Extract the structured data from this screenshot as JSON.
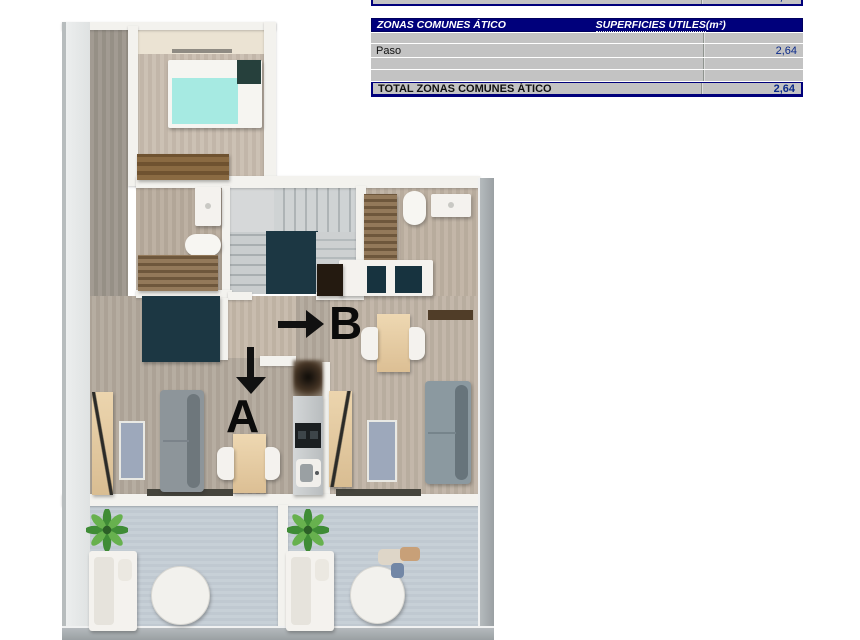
{
  "annotations": {
    "marker_a": "A",
    "marker_b": "B"
  },
  "table": {
    "row_estudio": {
      "label_u": "TOTAL",
      "label_rest": " ESTUDIO ÁTICO B",
      "value": "40,76"
    },
    "header": {
      "col1_u": "ZONAS",
      "col1_rest": " COMUNES ÁTICO",
      "col2_u": "SUPERFICIES UTILES",
      "col2_rest": "  (m²)"
    },
    "rows": [
      {
        "label": "",
        "value": ""
      },
      {
        "label": "Paso",
        "value": "2,64"
      },
      {
        "label": "",
        "value": ""
      },
      {
        "label": "",
        "value": ""
      }
    ],
    "row_total": {
      "label_u": "TOTAL",
      "label_rest": " ZONAS COMUNES ÁTICO",
      "value": "2,64"
    }
  },
  "colors": {
    "header-bg": "#00007b",
    "header-text": "#ffffff",
    "cell-bg": "#c3c3c3",
    "value-color": "#0b2a8a",
    "marker-color": "#0b0b0b",
    "terrace-floor": "#c4cdd5",
    "wood-floor": "#b2a89b",
    "navy-void": "#1c3743",
    "bed-teal": "#a6eae2"
  }
}
